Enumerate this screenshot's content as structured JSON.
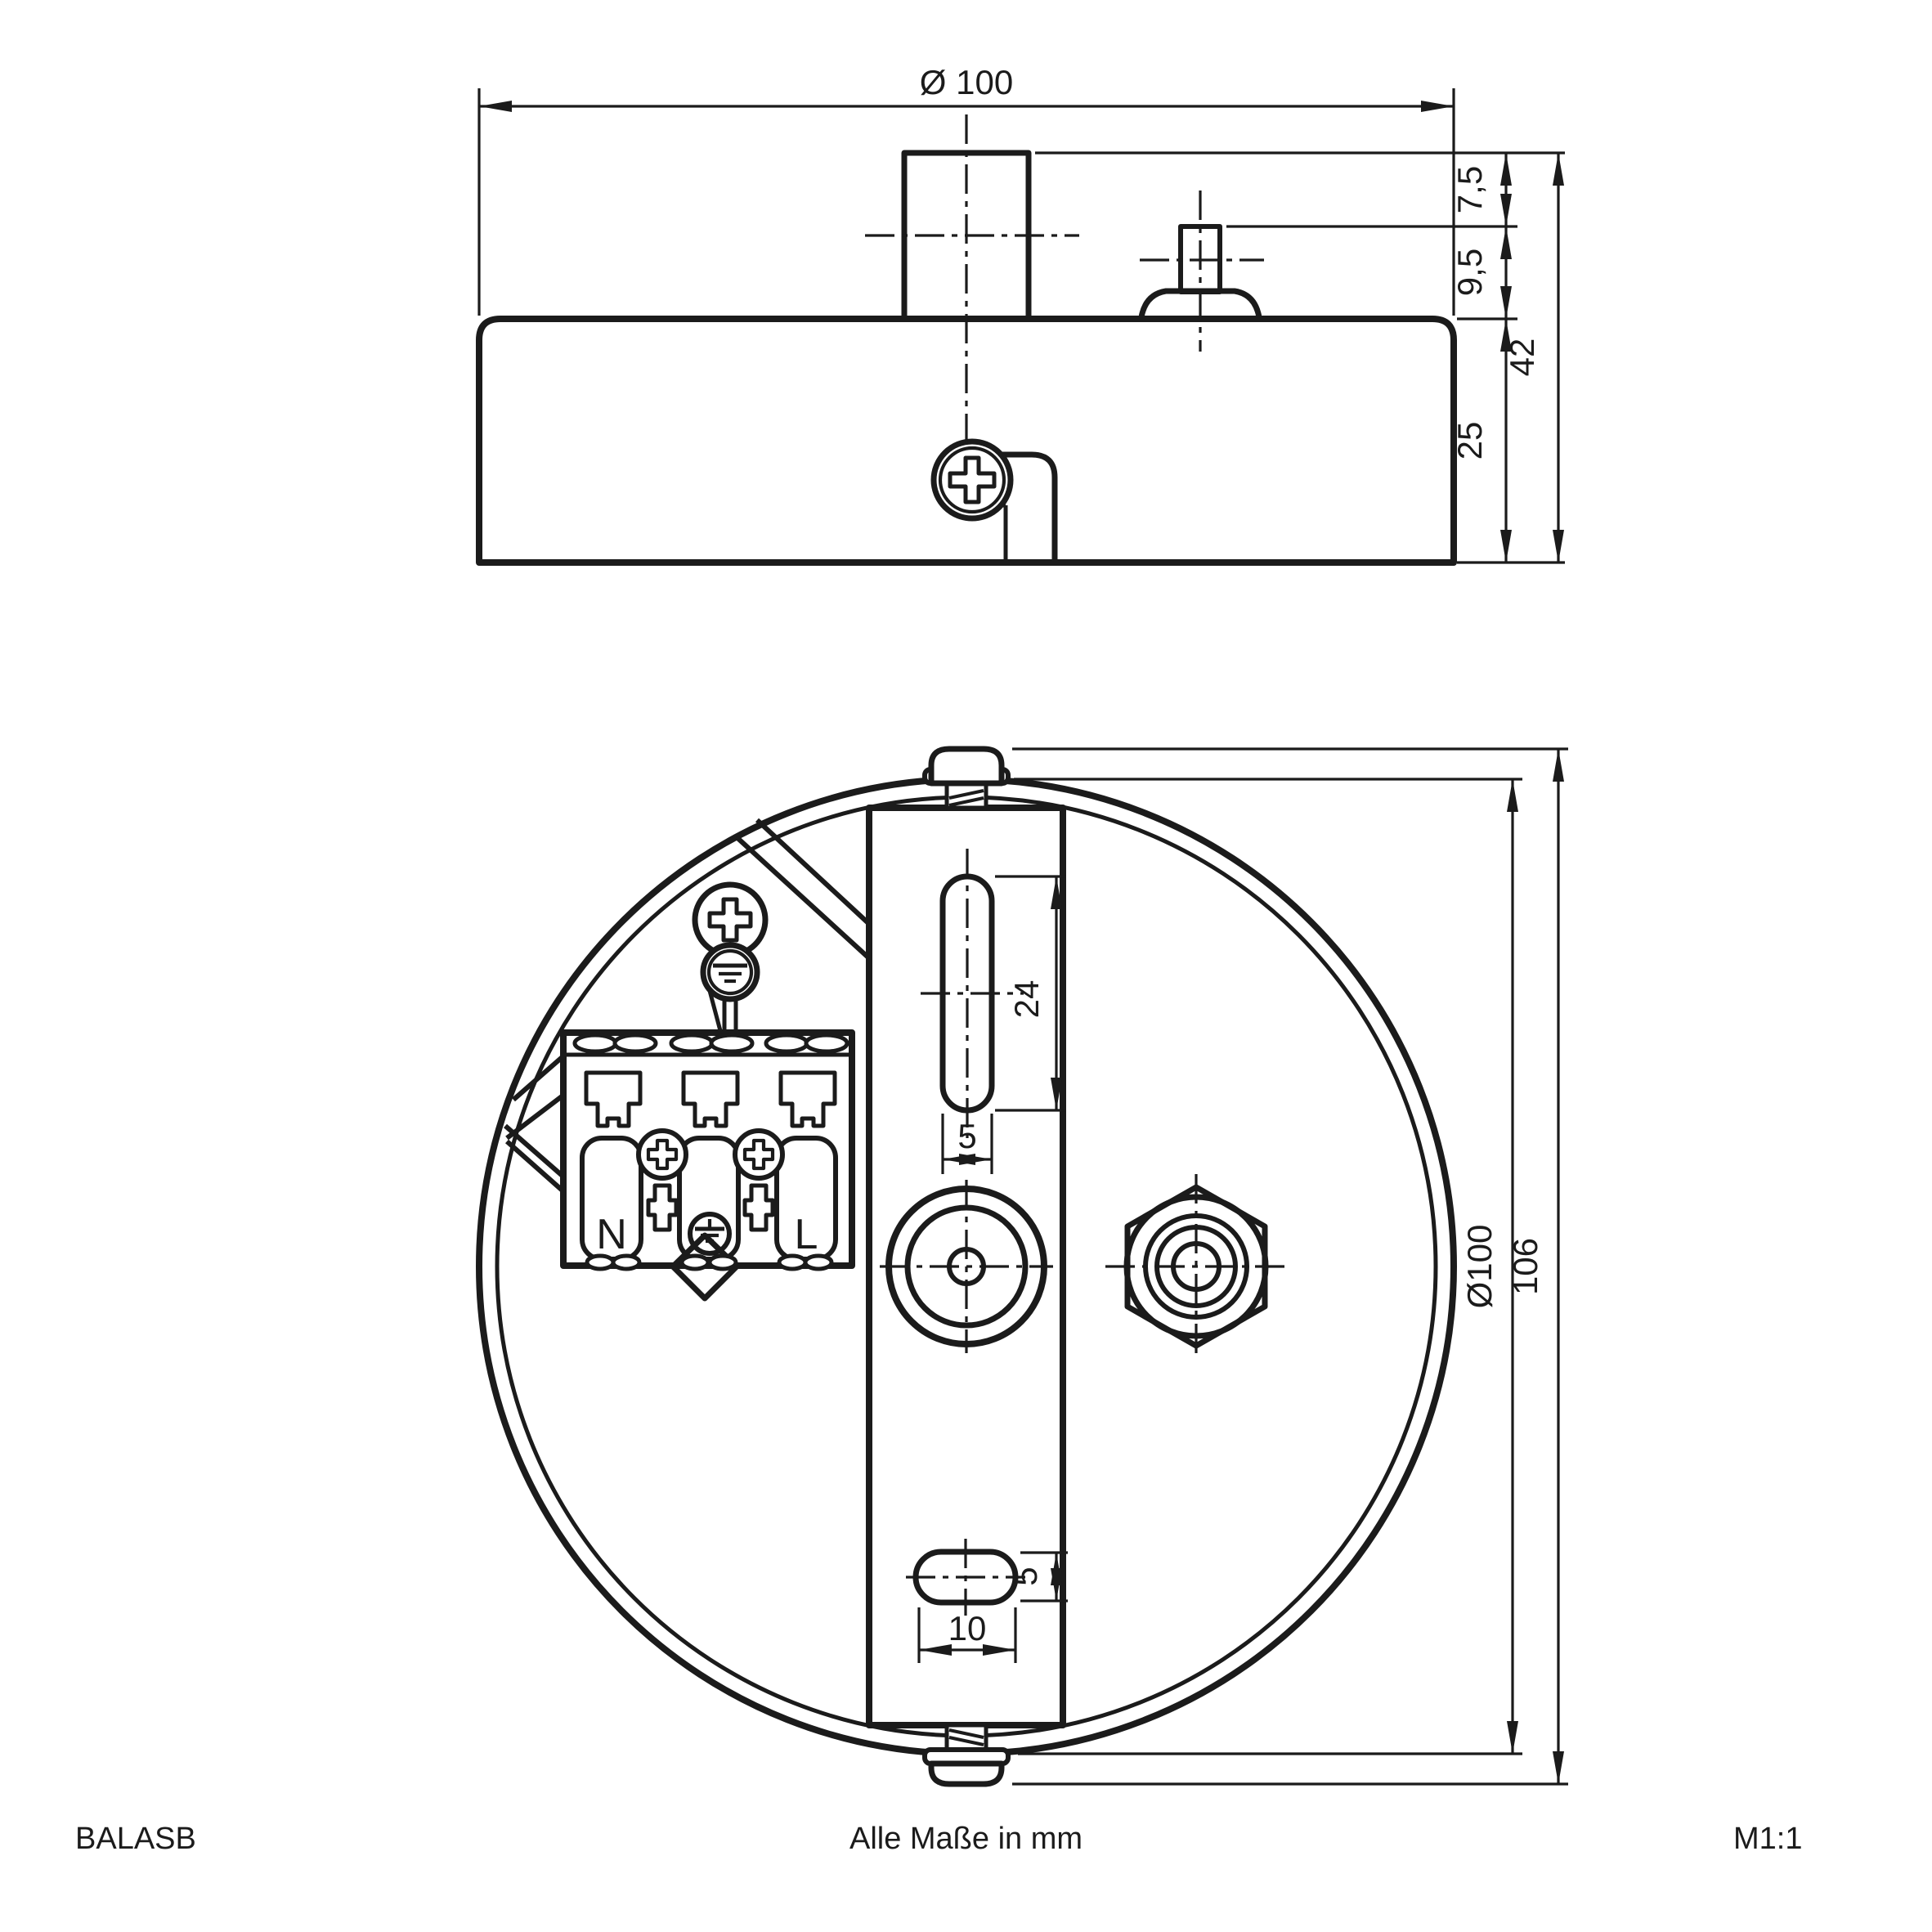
{
  "meta": {
    "background_color": "#ffffff",
    "line_color": "#1b1b1b"
  },
  "footer": {
    "product_code": "BALASB",
    "units_note": "Alle Maße in mm",
    "scale": "M1:1"
  },
  "side_view": {
    "dims": {
      "diameter": "Ø 100",
      "stem_height": "7,5",
      "stud_height": "9,5",
      "overall_height": "42",
      "body_height": "25"
    }
  },
  "plan_view": {
    "dims": {
      "slot_length": "24",
      "slot_width": "5",
      "hole_width": "5",
      "hole_length": "10",
      "body_diameter": "Ø100",
      "overall_size": "106"
    },
    "terminal_block": {
      "neutral_label": "N",
      "line_label": "L"
    }
  }
}
